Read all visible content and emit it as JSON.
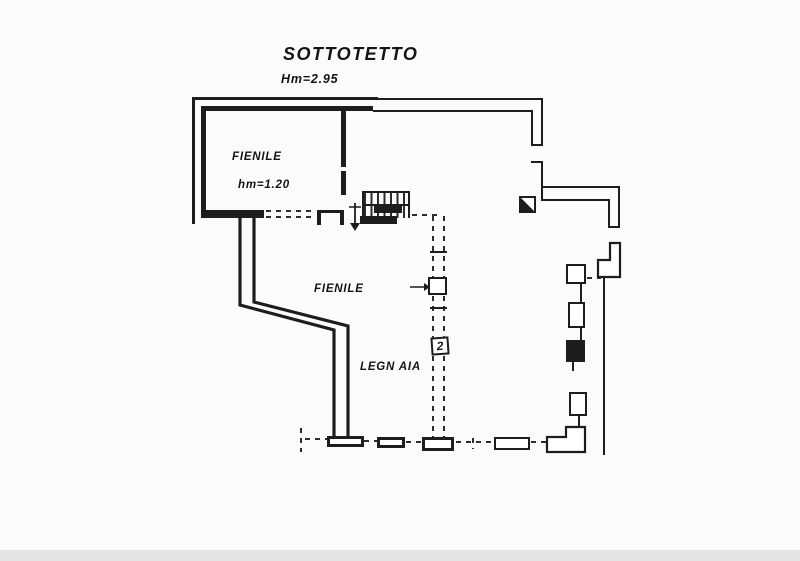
{
  "page": {
    "title": "SOTTOTETTO",
    "overall_height": "Hm=2.95"
  },
  "rooms": {
    "fienile_upper": {
      "label": "FIENILE",
      "height": "hm=1.20"
    },
    "fienile_main": {
      "label": "FIENILE"
    },
    "legnaia": {
      "label": "LEGN AIA"
    }
  },
  "symbols": {
    "flue_number": "2"
  },
  "colors": {
    "ink": "#1d1d1d",
    "paper": "#fbfbf9"
  }
}
